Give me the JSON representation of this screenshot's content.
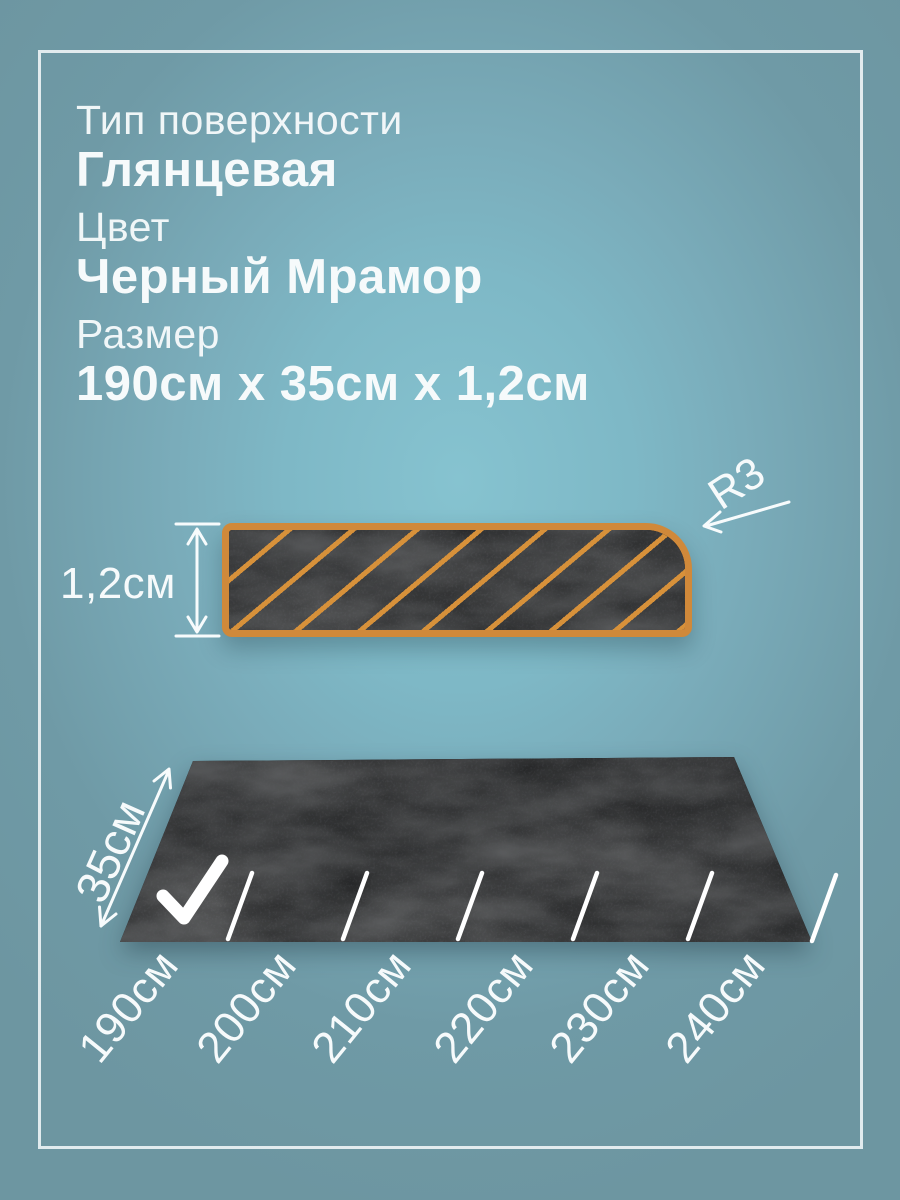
{
  "specs": {
    "surface": {
      "label": "Тип поверхности",
      "value": "Глянцевая"
    },
    "color": {
      "label": "Цвет",
      "value": "Черный Мрамор"
    },
    "size": {
      "label": "Размер",
      "value": "190см х 35см х 1,2см"
    }
  },
  "cross_section": {
    "thickness_label": "1,2см",
    "radius_label": "R3"
  },
  "slab": {
    "width_label": "35см",
    "size_labels": [
      "190см",
      "200см",
      "210см",
      "220см",
      "230см",
      "240см"
    ],
    "selected_size": "190см"
  },
  "icons": {
    "selected_mark": "checkmark-icon"
  },
  "colors": {
    "background_center": "#86c3d0",
    "background_edge": "#6d96a1",
    "frame": "#ebf2f4",
    "accent_orange": "#d0893a",
    "marble_base": "#232425",
    "text": "#f6fafb"
  }
}
